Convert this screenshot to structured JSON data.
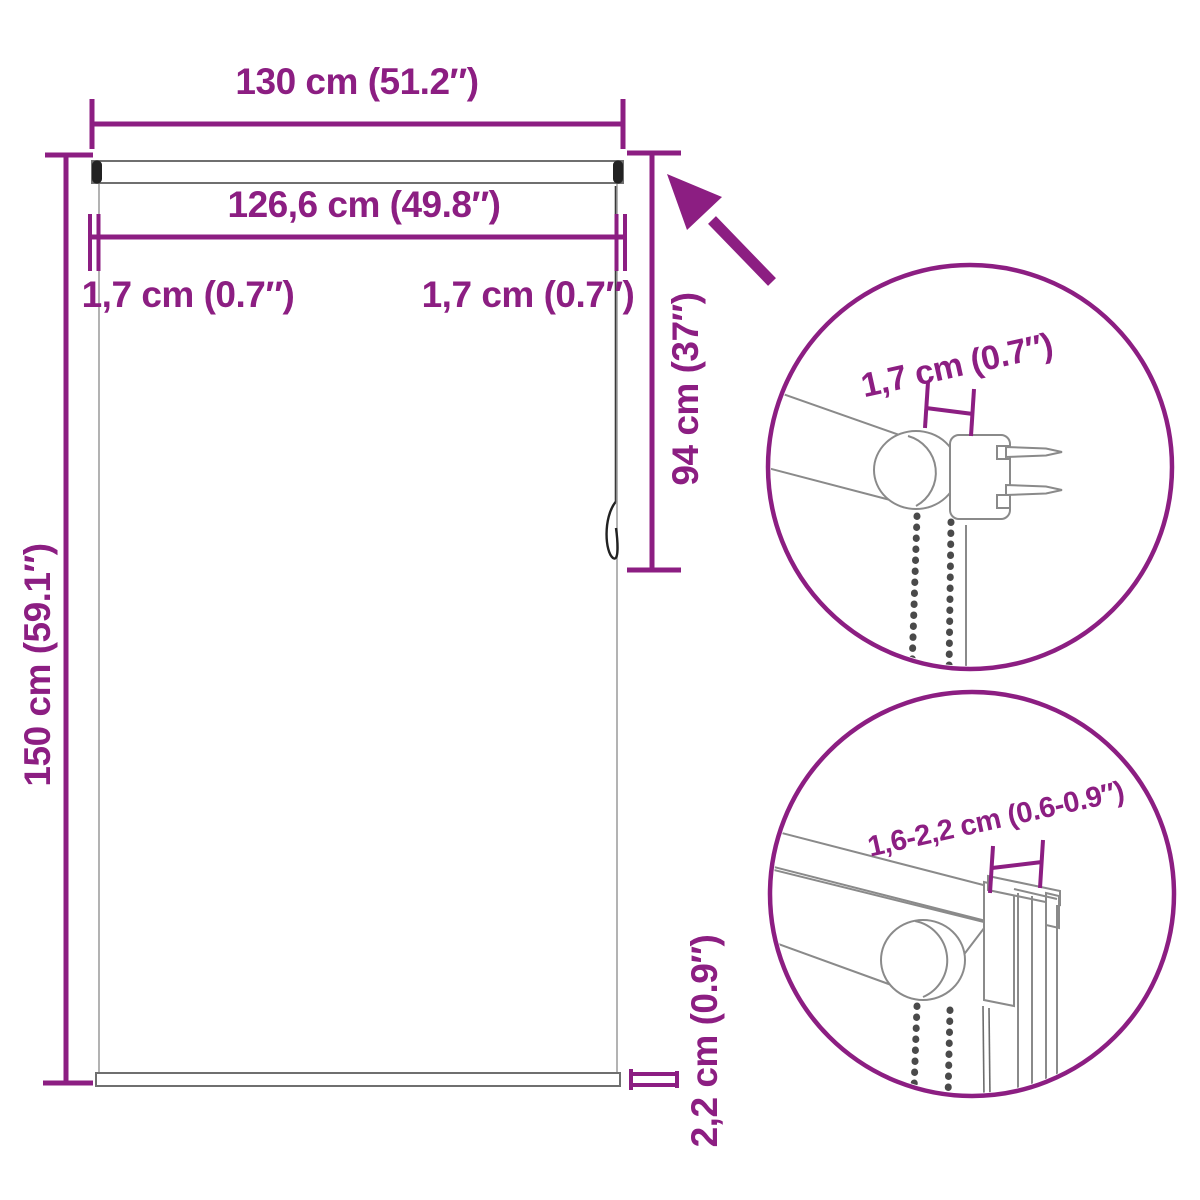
{
  "diagram": {
    "description": "Roller blind with chain - dimension drawing with two zoom detail circles",
    "labels": {
      "width_total": "130 cm (51.2″)",
      "width_fabric": "126,6 cm (49.8″)",
      "offset_left": "1,7 cm (0.7″)",
      "offset_right": "1,7 cm (0.7″)",
      "height_total": "150 cm (59.1″)",
      "chain_length": "94 cm (37″)",
      "bottom_bar": "2,2 cm (0.9″)"
    },
    "details": {
      "top_circle_label": "1,7 cm (0.7″)",
      "bottom_circle_label": "1,6-2,2 cm (0.6-0.9″)"
    },
    "colors": {
      "accent": "#8C1E82",
      "line": "#8a8a8a",
      "dark": "#222222",
      "background": "#ffffff"
    }
  }
}
